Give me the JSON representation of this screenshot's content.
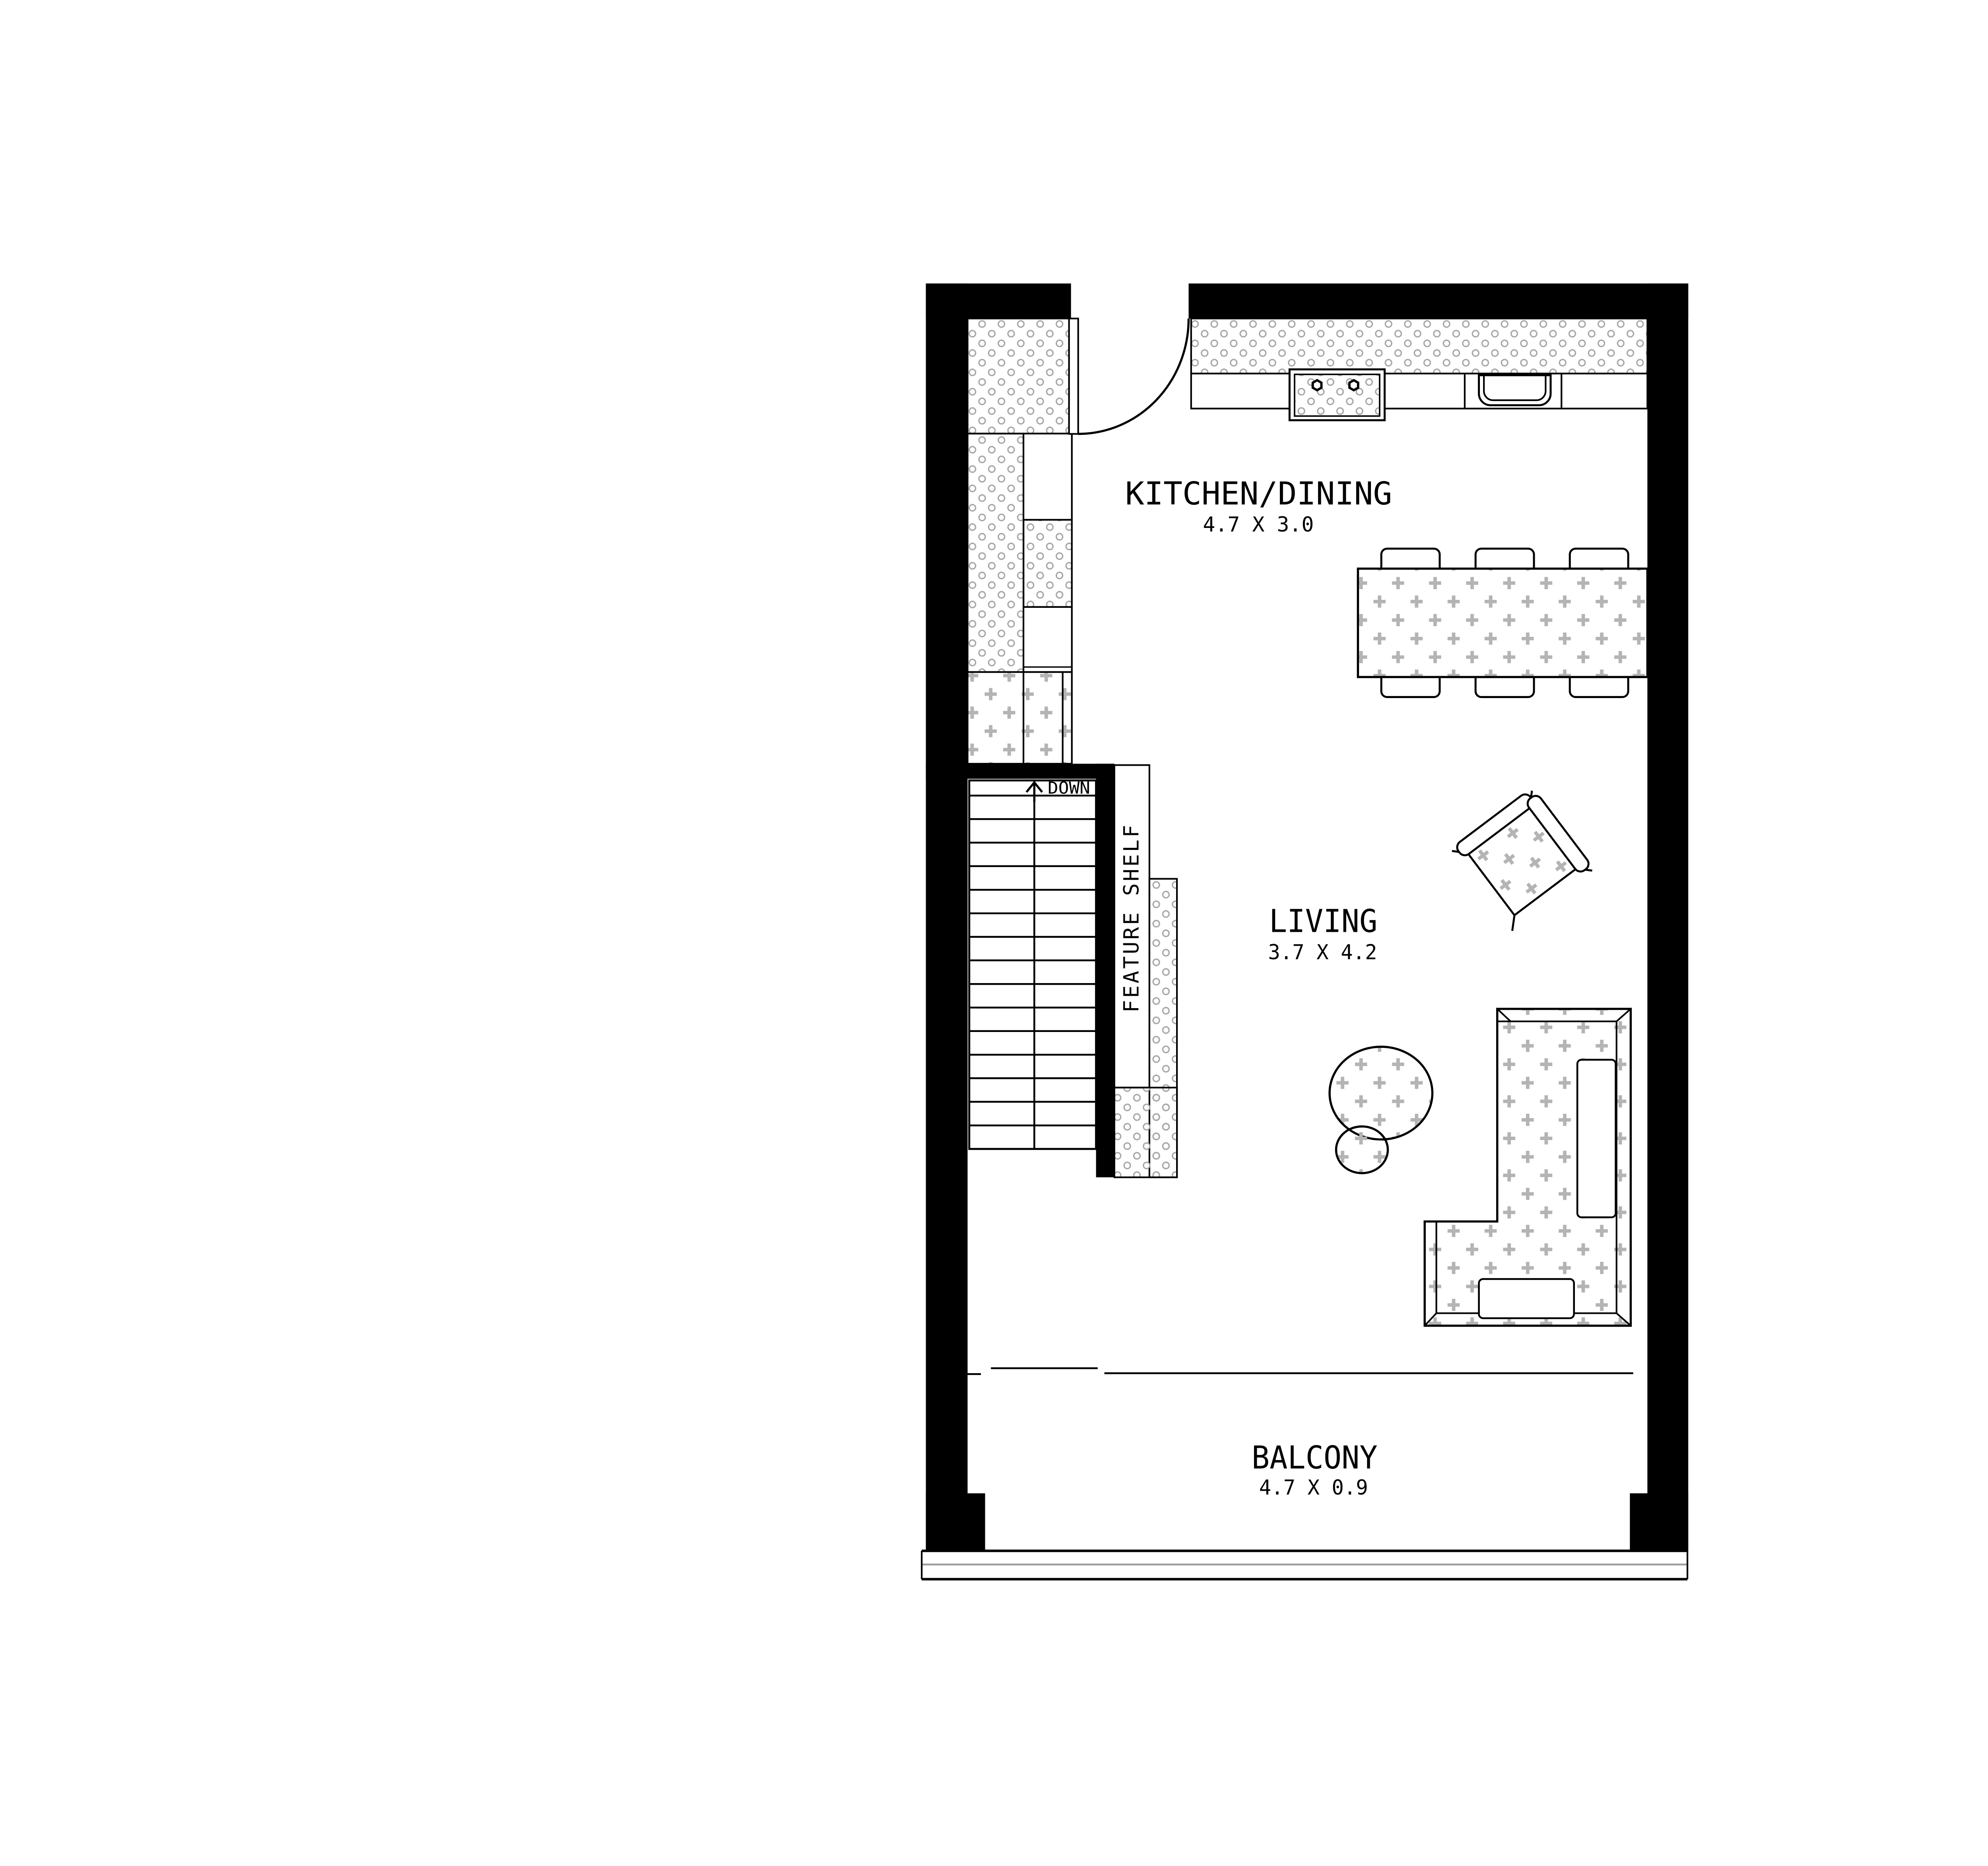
{
  "plan": {
    "rooms": [
      {
        "id": "kitchen-dining",
        "name": "KITCHEN/DINING",
        "dims": "4.7 X 3.0"
      },
      {
        "id": "living",
        "name": "LIVING",
        "dims": "3.7 X 4.2"
      },
      {
        "id": "balcony",
        "name": "BALCONY",
        "dims": "4.7 X 0.9"
      }
    ],
    "annotations": {
      "stair_direction": "DOWN",
      "shelf": "FEATURE SHELF"
    },
    "colors": {
      "wall": "#000000",
      "line": "#000000",
      "hatch_dot": "#a6a6a6",
      "hatch_plus": "#b4b4b4",
      "railing_gray": "#9b9b9b",
      "background": "#ffffff"
    }
  }
}
